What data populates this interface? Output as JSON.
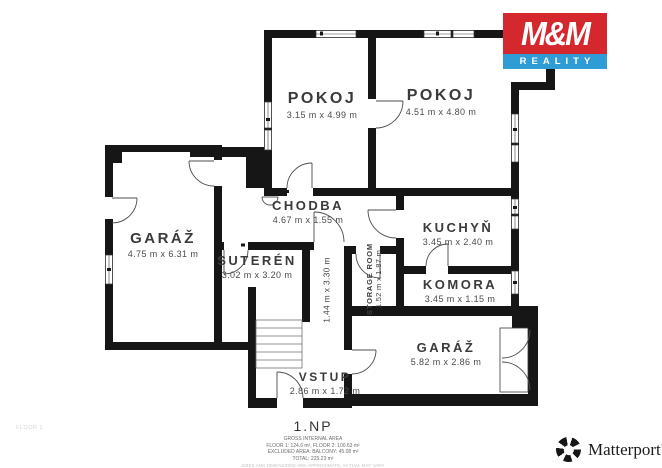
{
  "plan": {
    "rooms": [
      {
        "id": "pokoj-1",
        "name": "POKOJ",
        "dims": "3.15 m x 4.99 m"
      },
      {
        "id": "pokoj-2",
        "name": "POKOJ",
        "dims": "4.51 m x 4.80 m"
      },
      {
        "id": "garaz-1",
        "name": "GARÁŽ",
        "dims": "4.75 m x 6.31 m"
      },
      {
        "id": "chodba",
        "name": "CHODBA",
        "dims": "4.67 m x 1.55 m"
      },
      {
        "id": "suteren",
        "name": "SUTERÉN",
        "dims": "3.02 m x 3.20 m"
      },
      {
        "id": "kuchyn",
        "name": "KUCHYŇ",
        "dims": "3.45 m x 2.40 m"
      },
      {
        "id": "komora",
        "name": "KOMORA",
        "dims": "3.45 m x 1.15 m"
      },
      {
        "id": "storage-room",
        "name": "STORAGE ROOM",
        "dims": "1.52 m x 1.87 m"
      },
      {
        "id": "garaz-2",
        "name": "GARÁŽ",
        "dims": "5.82 m x 2.86 m"
      },
      {
        "id": "vstup",
        "name": "VSTUP",
        "dims": "2.86 m x 1.72 m"
      }
    ],
    "hallway_dims": "1.44 m x 3.30 m"
  },
  "branding": {
    "mm_reality": {
      "top": "M&M",
      "bottom": "REALITY",
      "red": "#d4272e",
      "blue": "#2f9cd6"
    },
    "matterport": {
      "label": "Matterport",
      "tm": "™"
    }
  },
  "footer": {
    "floor_label": "1.NP",
    "area_lines": [
      "GROSS INTERNAL AREA",
      "FLOOR 1: 124.6 m², FLOOR 2: 100.63 m²",
      "EXCLUDED AREA: BALCONY: 45.08 m²",
      "TOTAL: 225.23 m²"
    ],
    "disclaimer": "SIZES AND DIMENSIONS ARE APPROXIMATE, ACTUAL MAY VARY",
    "corner_label": "FLOOR 1"
  }
}
